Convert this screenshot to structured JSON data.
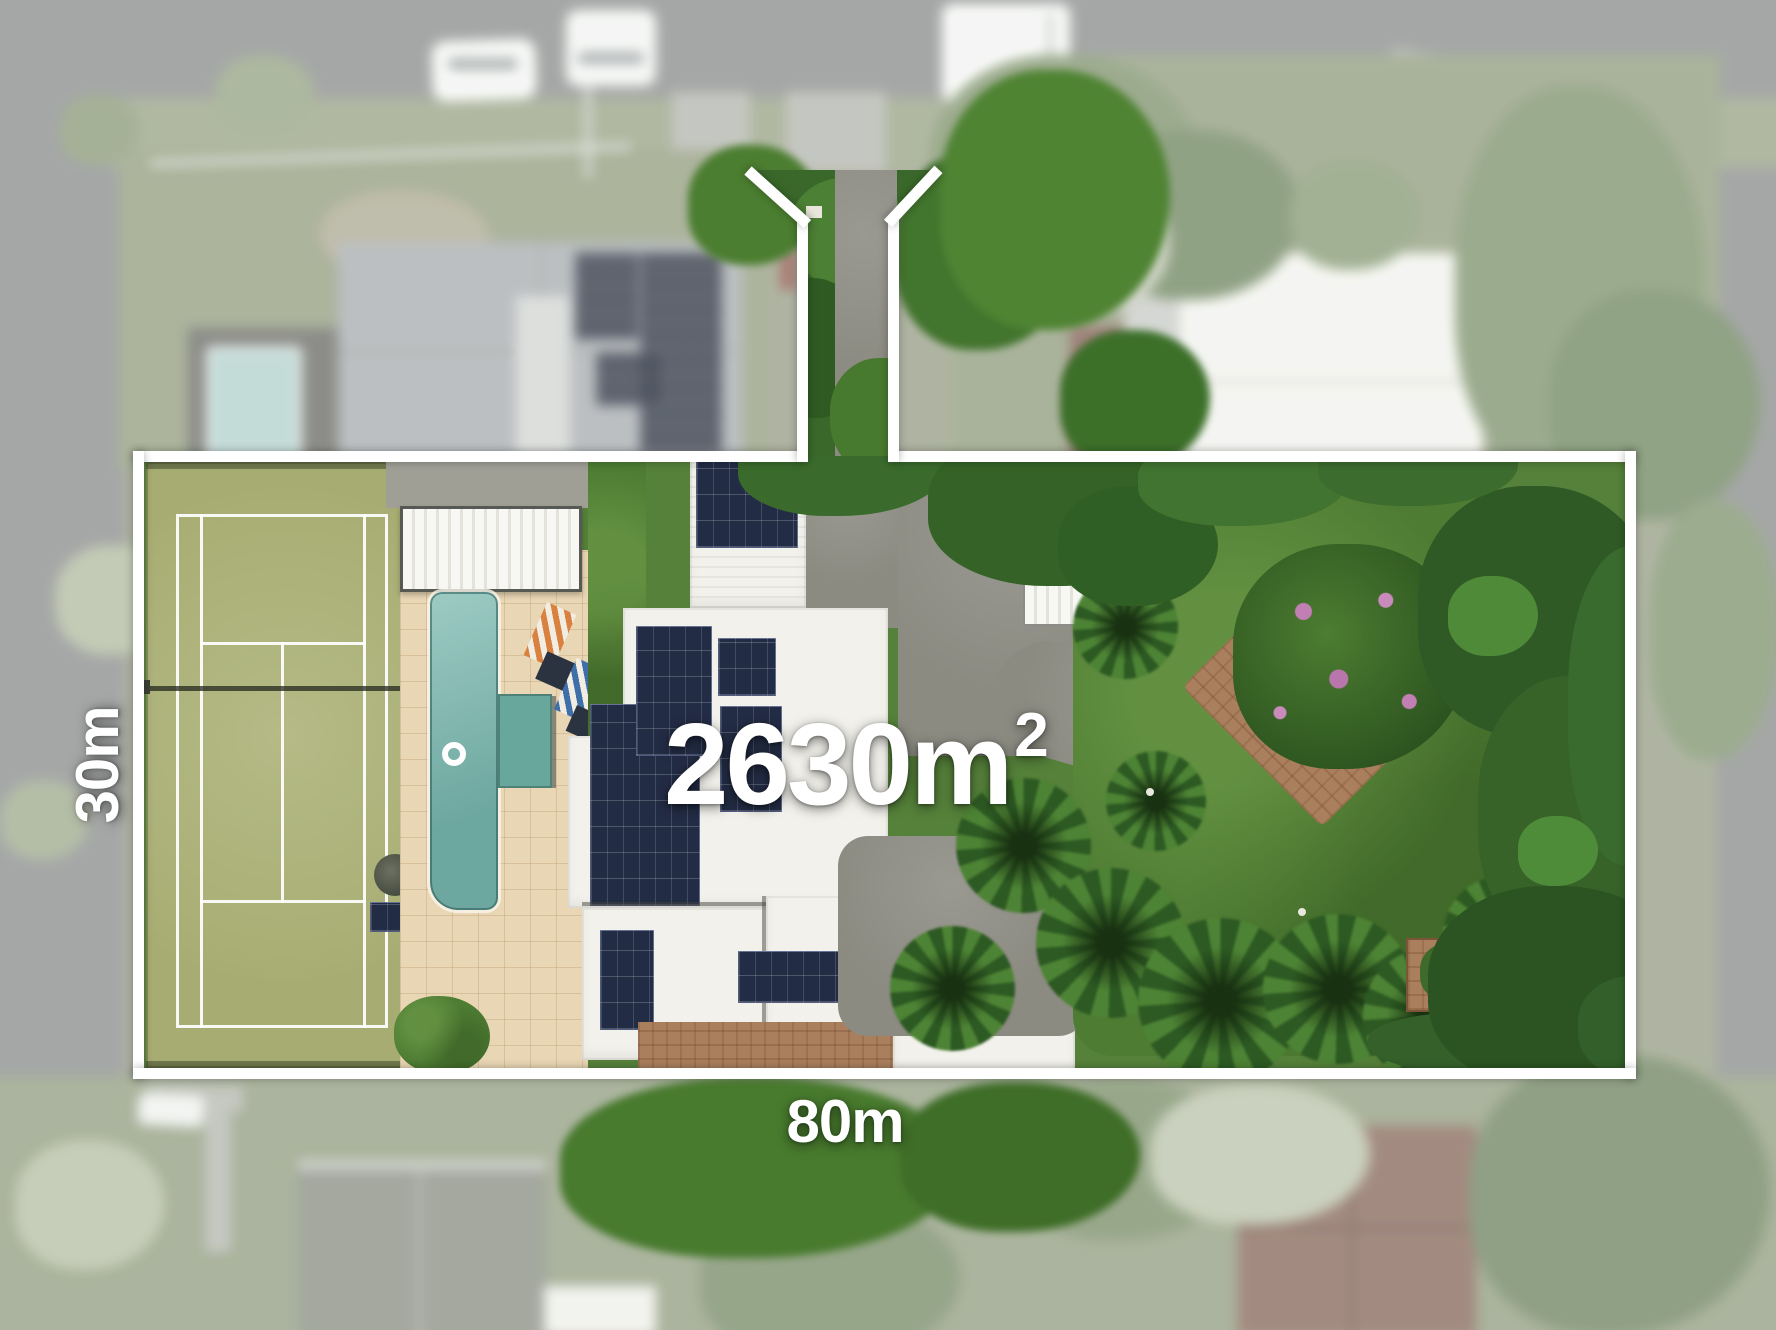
{
  "labels": {
    "area_value": "2630",
    "area_unit": "m",
    "area_superscript": "2",
    "frontage": "80m",
    "depth": "30m"
  },
  "colors": {
    "boundary": "#ffffff",
    "label_text": "#ffffff",
    "pool_water": "#7cb9b0",
    "tennis_court": "#a7ad72",
    "lawn": "#4e7c33",
    "paving": "#e9d6b4",
    "solar_panel": "#232c45",
    "roof_white": "#f2f1eb",
    "driveway_concrete": "#8c8b82",
    "road": "#8f9192",
    "dense_foliage": "#2f5a26"
  }
}
